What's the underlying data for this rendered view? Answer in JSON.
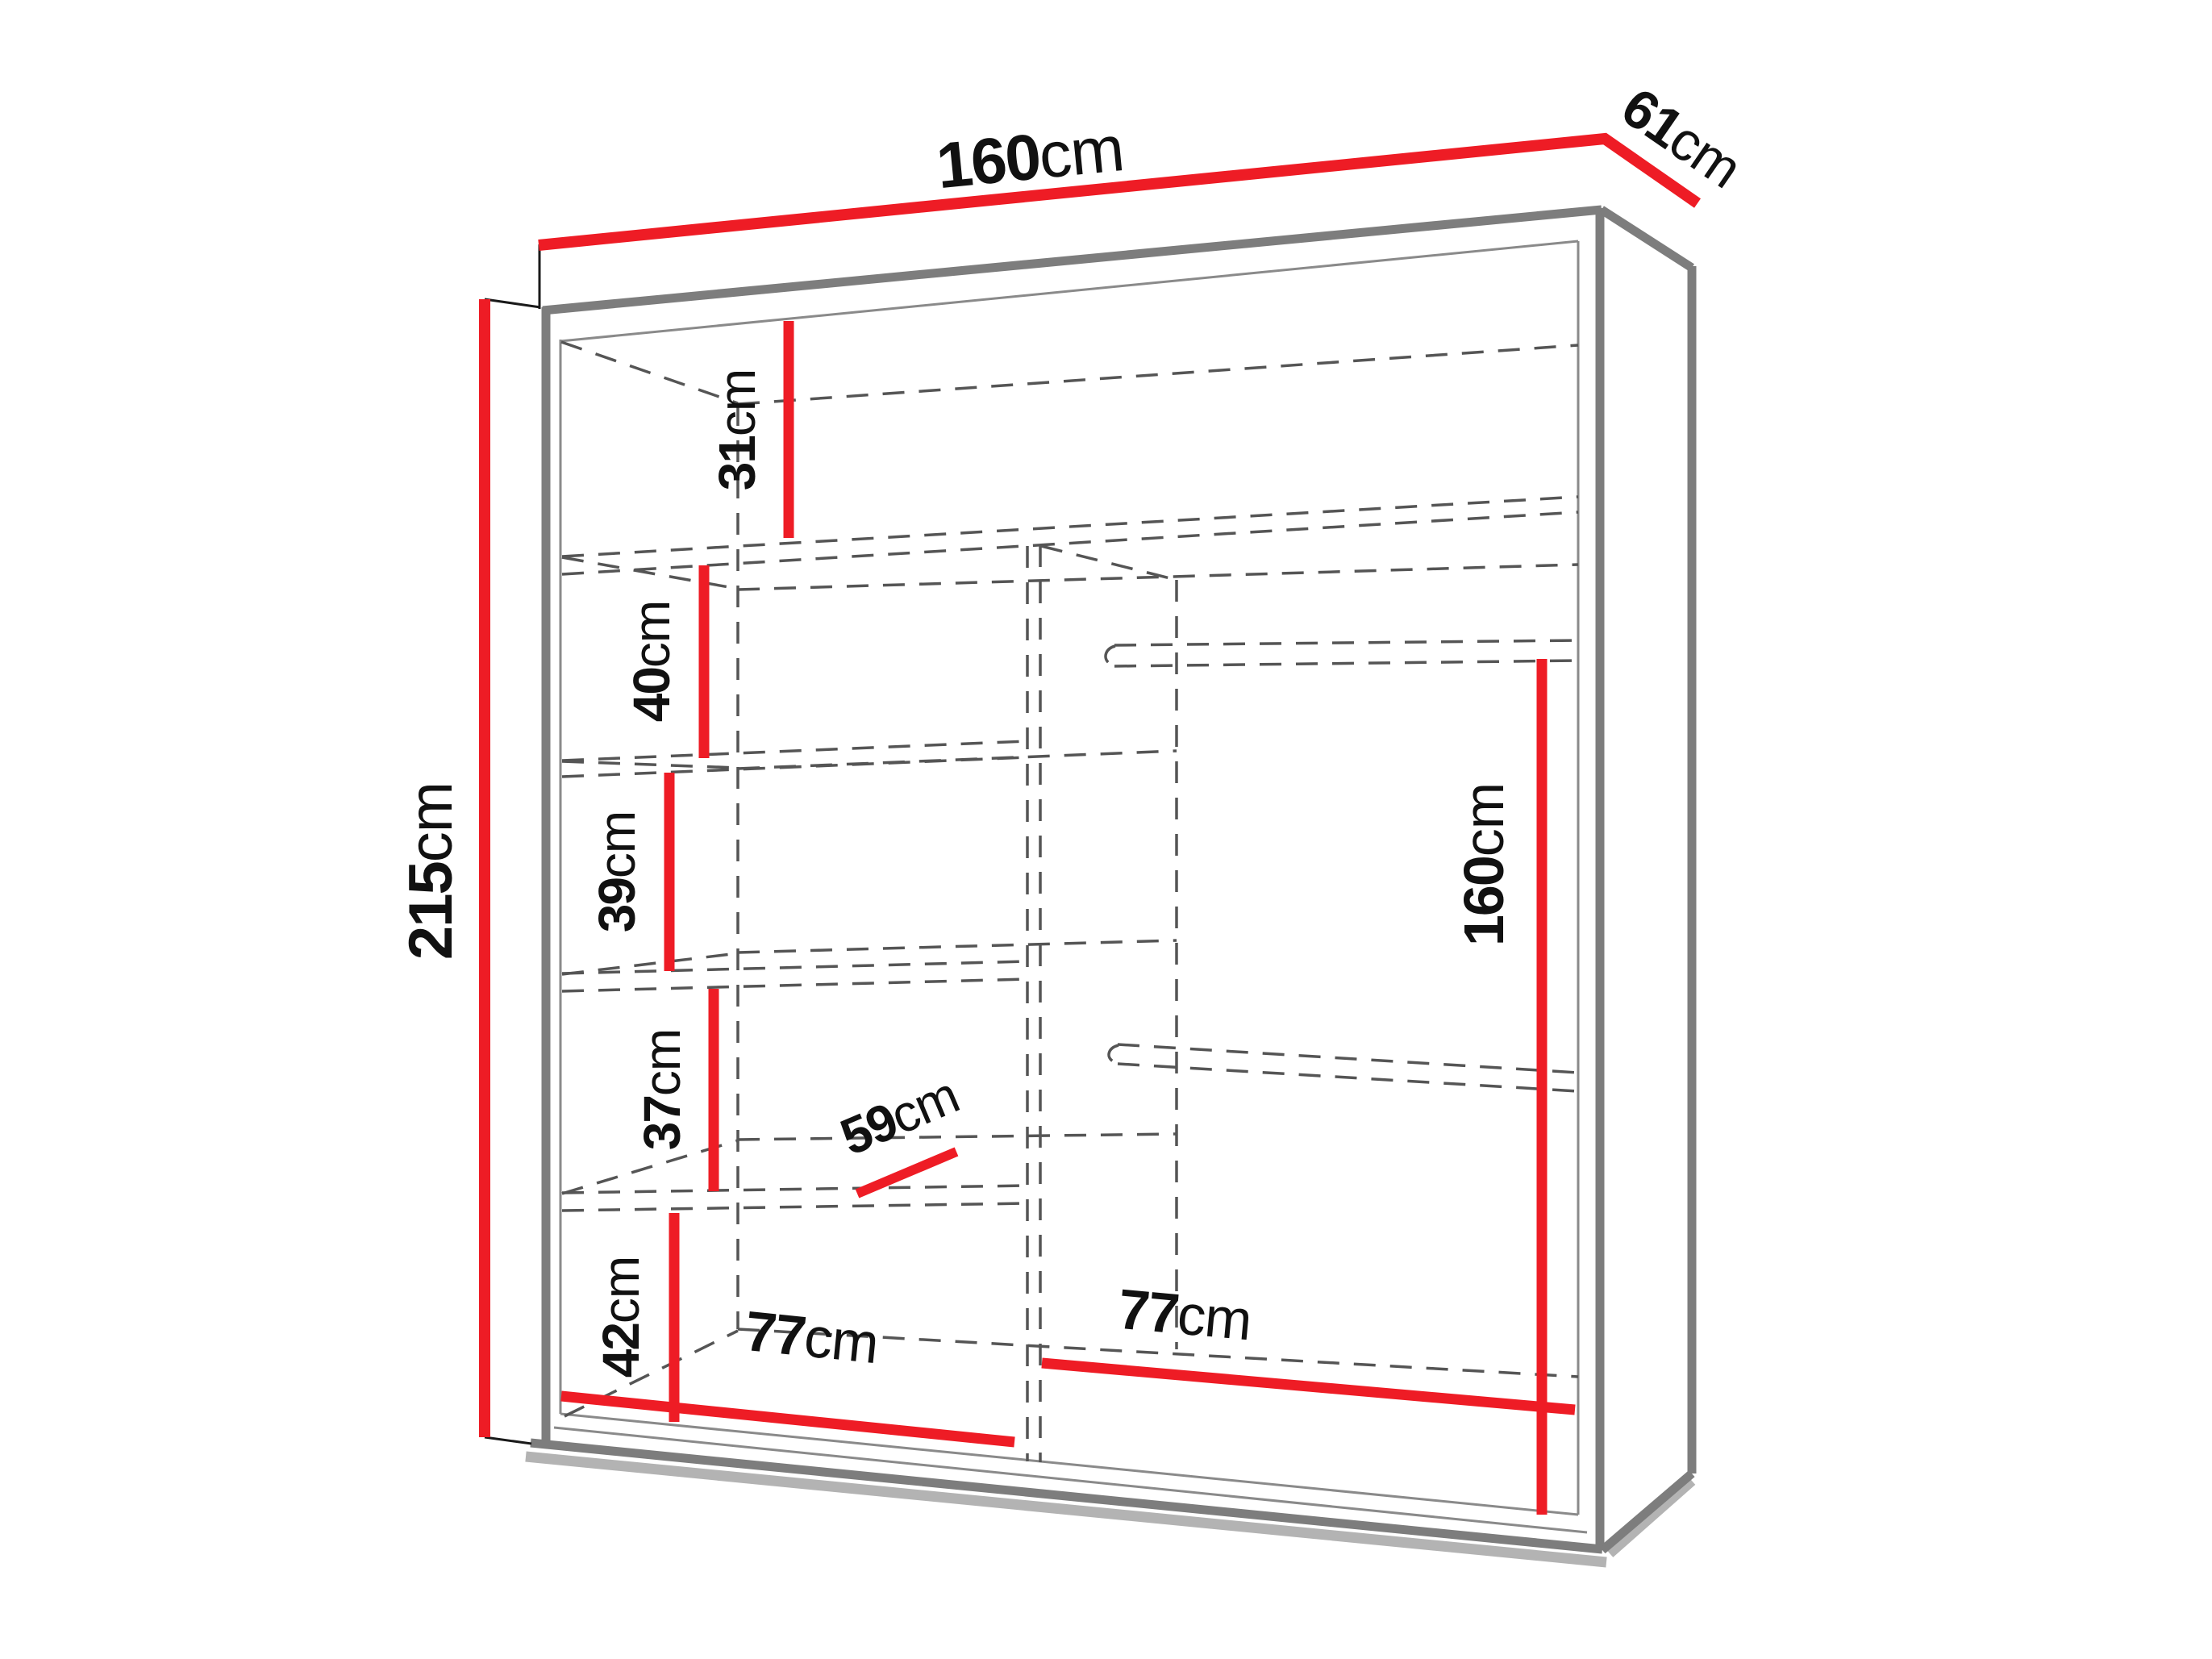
{
  "title": "Wardrobe dimensions diagram",
  "product": "two-section sliding wardrobe with shelves and hanging rails",
  "colors": {
    "dimension_red": "#ee1c25",
    "carcass_gray": "#7d7d7d",
    "hidden_line_gray": "#555555",
    "text_black": "#111111",
    "background": "#ffffff"
  },
  "measurements": {
    "overall_width": {
      "value": "160",
      "unit": "cm",
      "description": "total width, top edge"
    },
    "overall_depth": {
      "value": "61",
      "unit": "cm",
      "description": "total depth, top right edge"
    },
    "overall_height": {
      "value": "215",
      "unit": "cm",
      "description": "total height, left side"
    },
    "top_shelf_gap": {
      "value": "31",
      "unit": "cm",
      "description": "gap between top panel and first shelf"
    },
    "shelf_gap_2": {
      "value": "40",
      "unit": "cm",
      "description": "second compartment height"
    },
    "shelf_gap_3": {
      "value": "39",
      "unit": "cm",
      "description": "third compartment height"
    },
    "shelf_gap_4": {
      "value": "37",
      "unit": "cm",
      "description": "fourth compartment height"
    },
    "bottom_shelf_gap": {
      "value": "42",
      "unit": "cm",
      "description": "bottom compartment height"
    },
    "shelf_depth": {
      "value": "59",
      "unit": "cm",
      "description": "shelf interior depth"
    },
    "left_section_width": {
      "value": "77",
      "unit": "cm",
      "description": "left shelf section interior width"
    },
    "right_section_width": {
      "value": "77",
      "unit": "cm",
      "description": "right hanging section interior width"
    },
    "hanging_height": {
      "value": "160",
      "unit": "cm",
      "description": "hanging space height, right section"
    }
  }
}
